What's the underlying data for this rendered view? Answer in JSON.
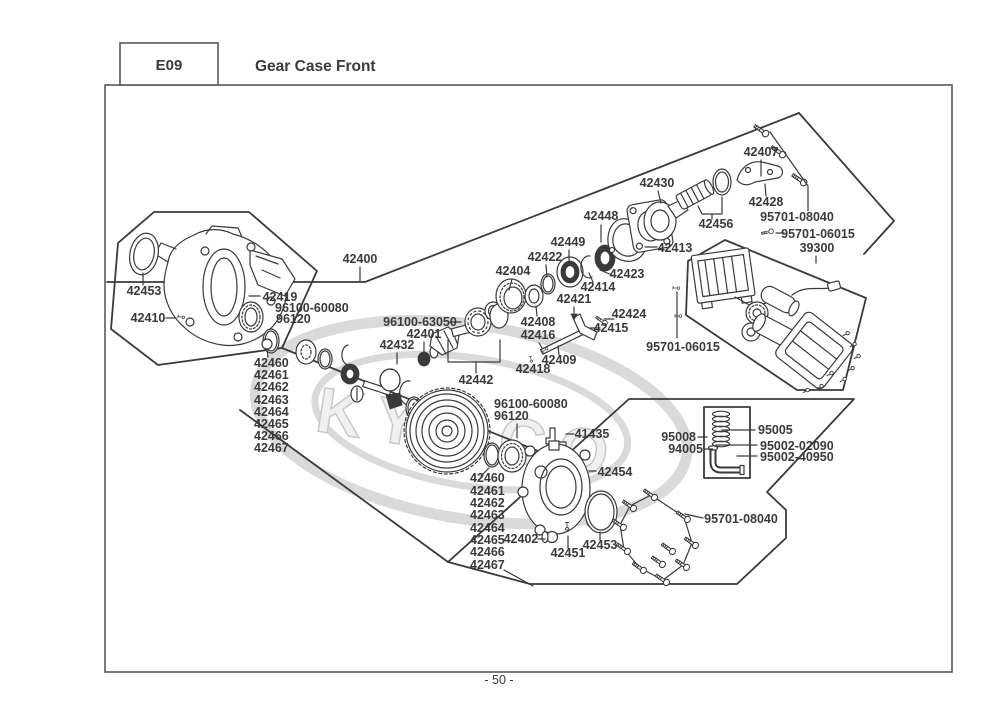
{
  "header": {
    "code": "E09",
    "title": "Gear Case Front"
  },
  "footer": {
    "page_number": "- 50 -"
  },
  "watermark": {
    "text": "KYMCO"
  },
  "colors": {
    "line": "#3a3a3a",
    "label": "#3a3a3a",
    "border": "#5a5a5a",
    "watermark": "#dadada"
  },
  "diagram": {
    "labels": [
      {
        "text": "42400",
        "x": 360,
        "y": 263
      },
      {
        "text": "42453",
        "x": 144,
        "y": 295
      },
      {
        "text": "42410",
        "x": 148,
        "y": 322
      },
      {
        "text": "42419",
        "x": 280,
        "y": 301
      },
      {
        "text": "96100-60080",
        "x": 275,
        "y": 312,
        "anchor": "start"
      },
      {
        "text": "96120",
        "x": 276,
        "y": 323,
        "anchor": "start"
      },
      {
        "text": "42460",
        "x": 254,
        "y": 367,
        "anchor": "start"
      },
      {
        "text": "42461",
        "x": 254,
        "y": 379,
        "anchor": "start"
      },
      {
        "text": "42462",
        "x": 254,
        "y": 391,
        "anchor": "start"
      },
      {
        "text": "42463",
        "x": 254,
        "y": 404,
        "anchor": "start"
      },
      {
        "text": "42464",
        "x": 254,
        "y": 416,
        "anchor": "start"
      },
      {
        "text": "42465",
        "x": 254,
        "y": 428,
        "anchor": "start"
      },
      {
        "text": "42466",
        "x": 254,
        "y": 440,
        "anchor": "start"
      },
      {
        "text": "42467",
        "x": 254,
        "y": 452,
        "anchor": "start"
      },
      {
        "text": "96100-63050",
        "x": 420,
        "y": 326
      },
      {
        "text": "42401",
        "x": 424,
        "y": 338
      },
      {
        "text": "42432",
        "x": 397,
        "y": 349
      },
      {
        "text": "42442",
        "x": 476,
        "y": 384
      },
      {
        "text": "42404",
        "x": 513,
        "y": 275
      },
      {
        "text": "42422",
        "x": 545,
        "y": 261
      },
      {
        "text": "42449",
        "x": 568,
        "y": 246
      },
      {
        "text": "42448",
        "x": 601,
        "y": 220
      },
      {
        "text": "42430",
        "x": 657,
        "y": 187
      },
      {
        "text": "42456",
        "x": 716,
        "y": 228
      },
      {
        "text": "42413",
        "x": 675,
        "y": 252
      },
      {
        "text": "42423",
        "x": 627,
        "y": 278
      },
      {
        "text": "42414",
        "x": 598,
        "y": 291
      },
      {
        "text": "42421",
        "x": 574,
        "y": 303
      },
      {
        "text": "42424",
        "x": 629,
        "y": 318
      },
      {
        "text": "42415",
        "x": 611,
        "y": 332
      },
      {
        "text": "42408",
        "x": 538,
        "y": 326
      },
      {
        "text": "42416",
        "x": 538,
        "y": 339
      },
      {
        "text": "42409",
        "x": 559,
        "y": 364
      },
      {
        "text": "42418",
        "x": 533,
        "y": 373
      },
      {
        "text": "42407",
        "x": 761,
        "y": 156
      },
      {
        "text": "42428",
        "x": 766,
        "y": 206
      },
      {
        "text": "95701-08040",
        "x": 797,
        "y": 221
      },
      {
        "text": "95701-06015",
        "x": 818,
        "y": 238
      },
      {
        "text": "39300",
        "x": 817,
        "y": 252
      },
      {
        "text": "95701-06015",
        "x": 683,
        "y": 351
      },
      {
        "text": "96100-60080",
        "x": 494,
        "y": 408,
        "anchor": "start"
      },
      {
        "text": "96120",
        "x": 494,
        "y": 420,
        "anchor": "start"
      },
      {
        "text": "41435",
        "x": 592,
        "y": 438
      },
      {
        "text": "42454",
        "x": 615,
        "y": 476
      },
      {
        "text": "42460",
        "x": 470,
        "y": 482,
        "anchor": "start"
      },
      {
        "text": "42461",
        "x": 470,
        "y": 495,
        "anchor": "start"
      },
      {
        "text": "42462",
        "x": 470,
        "y": 507,
        "anchor": "start"
      },
      {
        "text": "42463",
        "x": 470,
        "y": 519,
        "anchor": "start"
      },
      {
        "text": "42464",
        "x": 470,
        "y": 532,
        "anchor": "start"
      },
      {
        "text": "42465",
        "x": 470,
        "y": 544,
        "anchor": "start"
      },
      {
        "text": "42466",
        "x": 470,
        "y": 556,
        "anchor": "start"
      },
      {
        "text": "42467",
        "x": 470,
        "y": 569,
        "anchor": "start"
      },
      {
        "text": "42402",
        "x": 521,
        "y": 543
      },
      {
        "text": "42451",
        "x": 568,
        "y": 557
      },
      {
        "text": "42453",
        "x": 600,
        "y": 549
      },
      {
        "text": "95701-08040",
        "x": 741,
        "y": 523
      },
      {
        "text": "95005",
        "x": 758,
        "y": 434,
        "anchor": "start"
      },
      {
        "text": "95008",
        "x": 696,
        "y": 441,
        "anchor": "end"
      },
      {
        "text": "94005",
        "x": 703,
        "y": 453,
        "anchor": "end"
      },
      {
        "text": "95002-02090",
        "x": 760,
        "y": 450,
        "anchor": "start"
      },
      {
        "text": "95002-40950",
        "x": 760,
        "y": 461,
        "anchor": "start"
      }
    ]
  }
}
